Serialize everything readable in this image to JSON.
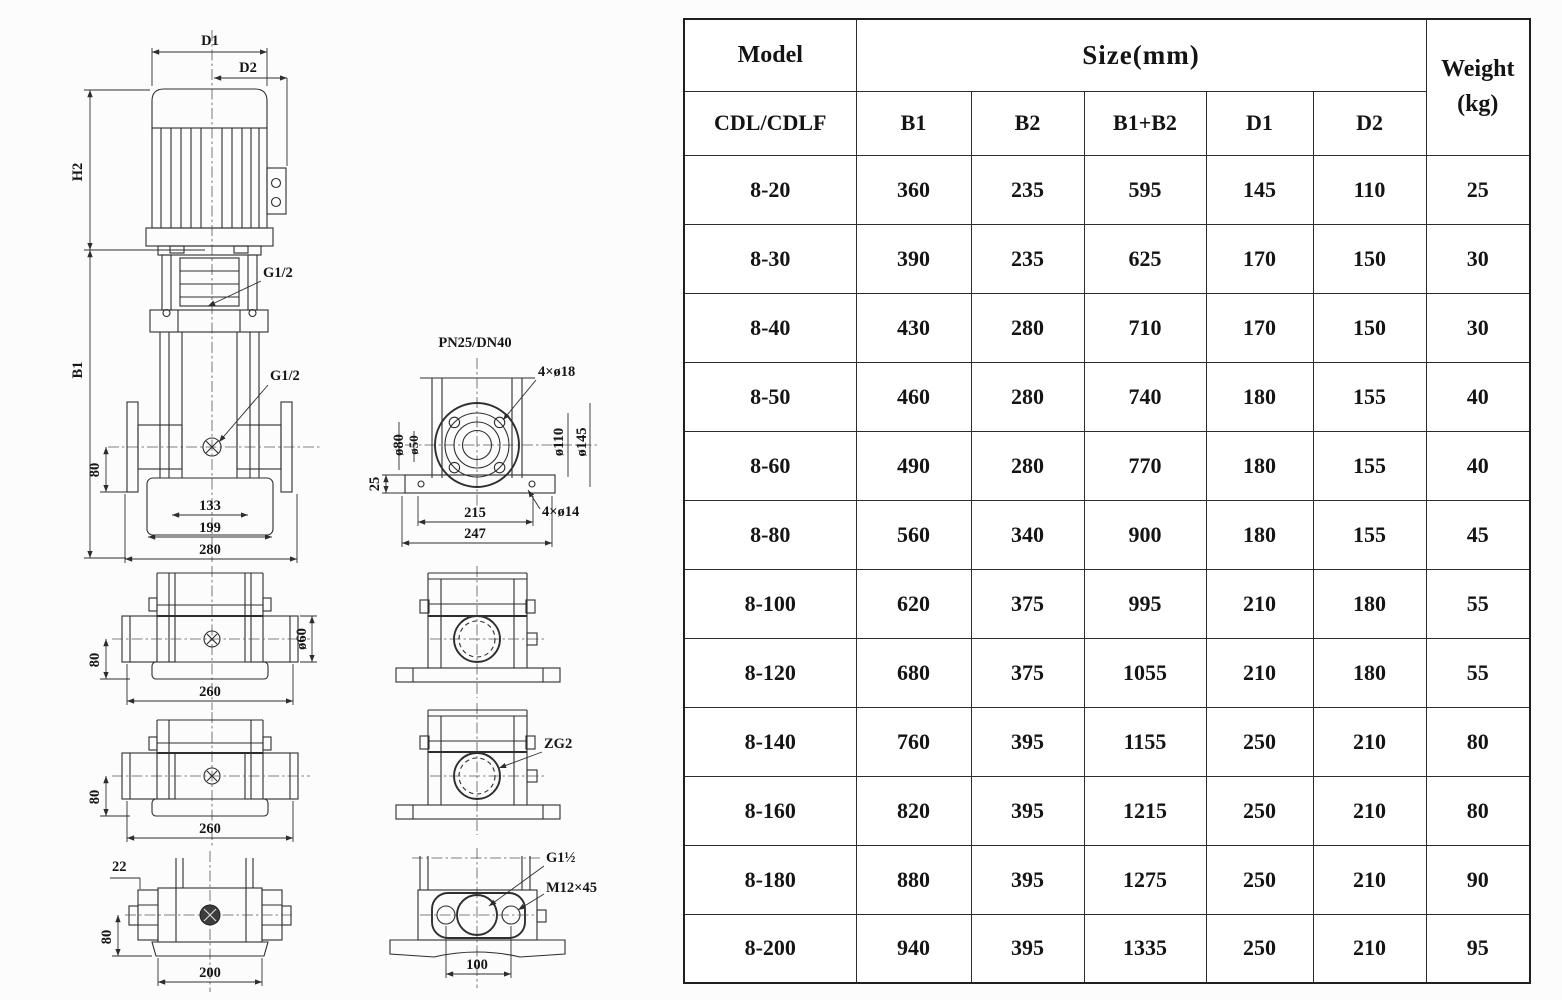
{
  "table": {
    "header": {
      "model": "Model",
      "size": "Size(mm)",
      "weight_line1": "Weight",
      "weight_line2": "(kg)",
      "model_sub": "CDL/CDLF",
      "size_cols": [
        "B1",
        "B2",
        "B1+B2",
        "D1",
        "D2"
      ]
    },
    "rows": [
      [
        "8-20",
        "360",
        "235",
        "595",
        "145",
        "110",
        "25"
      ],
      [
        "8-30",
        "390",
        "235",
        "625",
        "170",
        "150",
        "30"
      ],
      [
        "8-40",
        "430",
        "280",
        "710",
        "170",
        "150",
        "30"
      ],
      [
        "8-50",
        "460",
        "280",
        "740",
        "180",
        "155",
        "40"
      ],
      [
        "8-60",
        "490",
        "280",
        "770",
        "180",
        "155",
        "40"
      ],
      [
        "8-80",
        "560",
        "340",
        "900",
        "180",
        "155",
        "45"
      ],
      [
        "8-100",
        "620",
        "375",
        "995",
        "210",
        "180",
        "55"
      ],
      [
        "8-120",
        "680",
        "375",
        "1055",
        "210",
        "180",
        "55"
      ],
      [
        "8-140",
        "760",
        "395",
        "1155",
        "250",
        "210",
        "80"
      ],
      [
        "8-160",
        "820",
        "395",
        "1215",
        "250",
        "210",
        "80"
      ],
      [
        "8-180",
        "880",
        "395",
        "1275",
        "250",
        "210",
        "90"
      ],
      [
        "8-200",
        "940",
        "395",
        "1335",
        "250",
        "210",
        "95"
      ]
    ]
  },
  "drawing": {
    "front_view": {
      "d1": "D1",
      "d2": "D2",
      "h2": "H2",
      "b1": "B1",
      "g12_top": "G1/2",
      "g12_side": "G1/2",
      "dim_80": "80",
      "dim_133": "133",
      "dim_199": "199",
      "dim_280": "280"
    },
    "flange_view": {
      "title": "PN25/DN40",
      "bolt_holes": "4×ø18",
      "dia_80": "ø80",
      "dia_50": "ø50",
      "dia_110": "ø110",
      "dia_145": "ø145",
      "dim_25": "25",
      "dim_215": "215",
      "dim_247": "247",
      "base_holes": "4×ø14"
    },
    "pipe_view_top": {
      "dim_80": "80",
      "dim_260": "260",
      "dia_60": "ø60"
    },
    "pipe_view_mid": {
      "dim_80": "80",
      "dim_260": "260"
    },
    "port_view": {
      "zg2": "ZG2"
    },
    "thread_view": {
      "dim_22": "22",
      "dim_80": "80",
      "dim_200": "200"
    },
    "oval_view": {
      "thread": "G1½",
      "bolt": "M12×45",
      "dim_100": "100"
    }
  }
}
